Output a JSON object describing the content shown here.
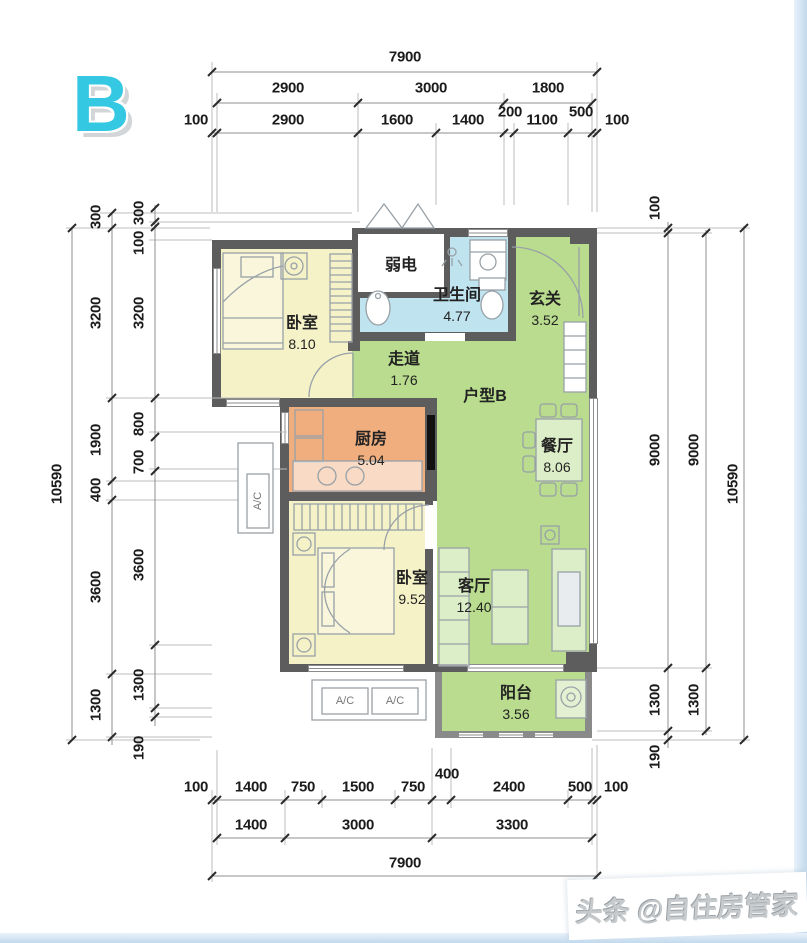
{
  "badge": "B",
  "unit_label": "户型B",
  "shaft_label": "弱电",
  "ac_label": "A/C",
  "watermark": {
    "prefix": "头条",
    "handle": "@自住房管家"
  },
  "rooms": {
    "bedroom1": {
      "name": "卧室",
      "area": "8.10"
    },
    "bathroom": {
      "name": "卫生间",
      "area": "4.77"
    },
    "entry": {
      "name": "玄关",
      "area": "3.52"
    },
    "corridor": {
      "name": "走道",
      "area": "1.76"
    },
    "kitchen": {
      "name": "厨房",
      "area": "5.04"
    },
    "dining": {
      "name": "餐厅",
      "area": "8.06"
    },
    "bedroom2": {
      "name": "卧室",
      "area": "9.52"
    },
    "living": {
      "name": "客厅",
      "area": "12.40"
    },
    "balcony": {
      "name": "阳台",
      "area": "3.56"
    }
  },
  "dims": {
    "top": {
      "total": "7900",
      "row2": [
        "2900",
        "3000",
        "1800"
      ],
      "row3": [
        "100",
        "2900",
        "1600",
        "1400",
        "200",
        "1100",
        "500",
        "100"
      ]
    },
    "bottom": {
      "row1": [
        "100",
        "1400",
        "750",
        "1500",
        "750",
        "400",
        "2400",
        "500",
        "100"
      ],
      "row2": [
        "1400",
        "3000",
        "3300"
      ],
      "total": "7900"
    },
    "left": {
      "total": "10590",
      "colB": [
        "300",
        "3200",
        "1900",
        "400",
        "3600",
        "1300"
      ],
      "colC": [
        "300",
        "100",
        "3200",
        "800",
        "700",
        "3600",
        "1300",
        "190"
      ]
    },
    "right": {
      "colInner": [
        "100",
        "9000",
        "1300",
        "190"
      ],
      "colMid": [
        "9000",
        "1300"
      ],
      "total": "10590"
    }
  },
  "colors": {
    "green": "#b9dc8e",
    "yellow": "#f6f2c8",
    "blue": "#bfe3ef",
    "orange": "#f0ad7e",
    "wall": "#5d5d5d",
    "accent": "#35c8e2"
  }
}
